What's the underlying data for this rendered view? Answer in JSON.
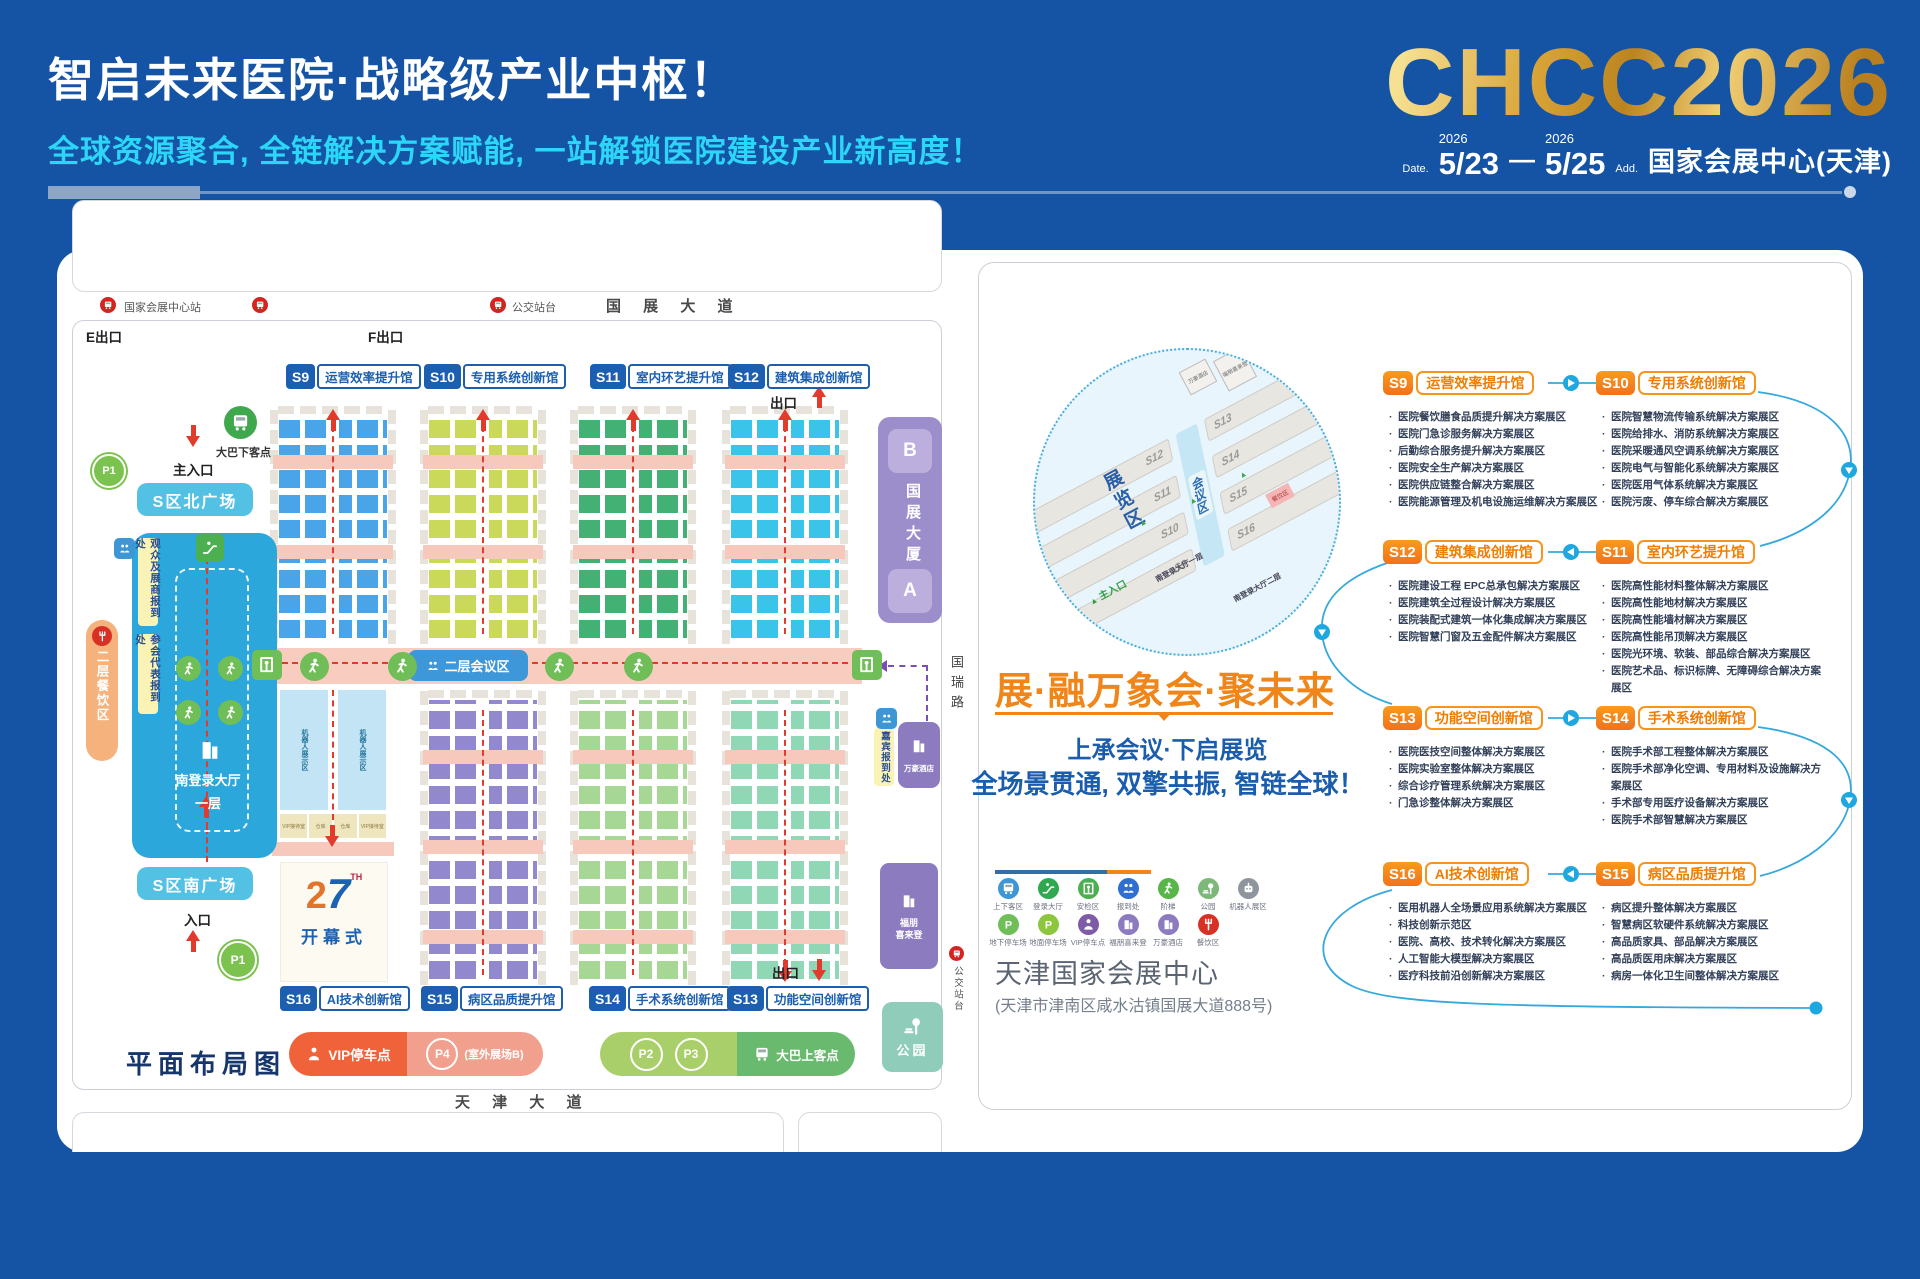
{
  "header": {
    "title": "智启未来医院·战略级产业中枢！",
    "subtitle": "全球资源聚合, 全链解决方案赋能, 一站解锁医院建设产业新高度！",
    "logo": "CHCC2026",
    "date_label": "Date.",
    "year1": "2026",
    "date1": "5/23",
    "year2": "2026",
    "date2": "5/25",
    "dash": "—",
    "addr_label": "Add.",
    "addr": "国家会展中心(天津)"
  },
  "map": {
    "title": "平面布局图",
    "road_top": "国 展 大 道",
    "road_bottom": "天 津 大 道",
    "road_right": "国瑞路",
    "metro_station": "国家会展中心站",
    "bus_stop": "公交站台",
    "exit_e": "E出口",
    "exit_f": "F出口",
    "exit": "出口",
    "main_entrance": "主入口",
    "entrance": "入口",
    "plaza_north": "S区北广场",
    "plaza_south": "S区南广场",
    "reg_visitor": "观众及展商报到处",
    "reg_delegate": "参会代表报到处",
    "reg_guest": "嘉宾报到处",
    "dining2f": "二层餐饮区",
    "lobby": "南登录大厅",
    "floor1": "一层",
    "conf2f": "二层会议区",
    "opening": "开幕式",
    "op2": "2",
    "op7": "7",
    "opth": "TH",
    "robot_zone": "机器人展示区",
    "vip_room": "VIP接待室",
    "storage": "仓库",
    "tower": "国展大厦",
    "tower_a": "A",
    "tower_b": "B",
    "marriott": "万豪酒店",
    "sheraton": "福朋喜来登",
    "park": "公园",
    "bus_drop": "大巴下客点",
    "bus_pick": "大巴上客点",
    "vip_parking": "VIP停车点",
    "p1": "P1",
    "p2": "P2",
    "p3": "P3",
    "p4": "P4",
    "p4_note": "(室外展场B)",
    "halls_top": [
      {
        "id": "S9",
        "name": "运营效率提升馆",
        "color": "#4AA5E8"
      },
      {
        "id": "S10",
        "name": "专用系统创新馆",
        "color": "#CBD95A"
      },
      {
        "id": "S11",
        "name": "室内环艺提升馆",
        "color": "#43B173"
      },
      {
        "id": "S12",
        "name": "建筑集成创新馆",
        "color": "#3BC4EA"
      }
    ],
    "halls_bottom": [
      {
        "id": "S16",
        "name": "AI技术创新馆",
        "color": "#BFE3F2"
      },
      {
        "id": "S15",
        "name": "病区品质提升馆",
        "color": "#9188CE"
      },
      {
        "id": "S14",
        "name": "手术系统创新馆",
        "color": "#A6D795"
      },
      {
        "id": "S13",
        "name": "功能空间创新馆",
        "color": "#8FD7B5"
      }
    ]
  },
  "panel": {
    "slogan1": "展·融万象",
    "slogan2": "会·聚未来",
    "line1": "上承会议·下启展览",
    "line2": "全场景贯通, 双擎共振, 智链全球！",
    "venue": "天津国家会展中心",
    "venue_addr": "(天津市津南区咸水沽镇国展大道888号)",
    "minimap": {
      "halls_left": [
        "S12",
        "S11",
        "S10",
        "S9"
      ],
      "halls_right": [
        "S13",
        "S14",
        "S15",
        "S16"
      ],
      "exhibit_area": "展览区",
      "conference_area": "会议区",
      "main_entrance": "主入口",
      "lobby_l1": "南登录大厅一层",
      "lobby_l2": "南登录大厅二层",
      "marriott": "万豪酒店",
      "sheraton": "福朋喜来登",
      "dining": "餐饮区"
    },
    "legend_row1": [
      {
        "label": "上下客区",
        "color": "#3E97D4",
        "icon": "bus"
      },
      {
        "label": "登录大厅",
        "color": "#2FA84F",
        "icon": "esc"
      },
      {
        "label": "安检区",
        "color": "#4CAF50",
        "icon": "gate"
      },
      {
        "label": "报到处",
        "color": "#2E6FD0",
        "icon": "people"
      },
      {
        "label": "阶梯",
        "color": "#57B647",
        "icon": "walk"
      },
      {
        "label": "公园",
        "color": "#7CB87A",
        "icon": "park"
      },
      {
        "label": "机器人展区",
        "color": "#8E959C",
        "icon": "robot"
      }
    ],
    "legend_row2": [
      {
        "label": "地下停车场",
        "color": "#6FBE57",
        "icon": "p"
      },
      {
        "label": "地面停车场",
        "color": "#8CC63F",
        "icon": "p"
      },
      {
        "label": "VIP停车点",
        "color": "#7D5BA6",
        "icon": "person"
      },
      {
        "label": "福朋喜来登",
        "color": "#8D7BC0",
        "icon": "building"
      },
      {
        "label": "万豪酒店",
        "color": "#8D7BC0",
        "icon": "building"
      },
      {
        "label": "餐饮区",
        "color": "#D93025",
        "icon": "fork"
      }
    ],
    "sections": {
      "S9": {
        "id": "S9",
        "name": "运营效率提升馆",
        "items": [
          "医院餐饮膳食品质提升解决方案展区",
          "医院门急诊服务解决方案展区",
          "后勤综合服务提升解决方案展区",
          "医院安全生产解决方案展区",
          "医院供应链整合解决方案展区",
          "医院能源管理及机电设施运维解决方案展区"
        ]
      },
      "S10": {
        "id": "S10",
        "name": "专用系统创新馆",
        "items": [
          "医院智慧物流传输系统解决方案展区",
          "医院给排水、消防系统解决方案展区",
          "医院采暖通风空调系统解决方案展区",
          "医院电气与智能化系统解决方案展区",
          "医院医用气体系统解决方案展区",
          "医院污废、停车综合解决方案展区"
        ]
      },
      "S12": {
        "id": "S12",
        "name": "建筑集成创新馆",
        "items": [
          "医院建设工程 EPC总承包解决方案展区",
          "医院建筑全过程设计解决方案展区",
          "医院装配式建筑一体化集成解决方案展区",
          "医院智慧门窗及五金配件解决方案展区"
        ]
      },
      "S11": {
        "id": "S11",
        "name": "室内环艺提升馆",
        "items": [
          "医院高性能材料整体解决方案展区",
          "医院高性能地材解决方案展区",
          "医院高性能墙材解决方案展区",
          "医院高性能吊顶解决方案展区",
          "医院光环境、软装、部品综合解决方案展区",
          "医院艺术品、标识标牌、无障碍综合解决方案展区"
        ]
      },
      "S13": {
        "id": "S13",
        "name": "功能空间创新馆",
        "items": [
          "医院医技空间整体解决方案展区",
          "医院实验室整体解决方案展区",
          "综合诊疗管理系统解决方案展区",
          "门急诊整体解决方案展区"
        ]
      },
      "S14": {
        "id": "S14",
        "name": "手术系统创新馆",
        "items": [
          "医院手术部工程整体解决方案展区",
          "医院手术部净化空调、专用材料及设施解决方案展区",
          "手术部专用医疗设备解决方案展区",
          "医院手术部智慧解决方案展区"
        ]
      },
      "S16": {
        "id": "S16",
        "name": "AI技术创新馆",
        "items": [
          "医用机器人全场景应用系统解决方案展区",
          "科技创新示范区",
          "医院、高校、技术转化解决方案展区",
          "人工智能大模型解决方案展区",
          "医疗科技前沿创新解决方案展区"
        ]
      },
      "S15": {
        "id": "S15",
        "name": "病区品质提升馆",
        "items": [
          "病区提升整体解决方案展区",
          "智慧病区软硬件系统解决方案展区",
          "高品质家具、部品解决方案展区",
          "高品质医用床解决方案展区",
          "病房一体化卫生间整体解决方案展区"
        ]
      }
    }
  }
}
